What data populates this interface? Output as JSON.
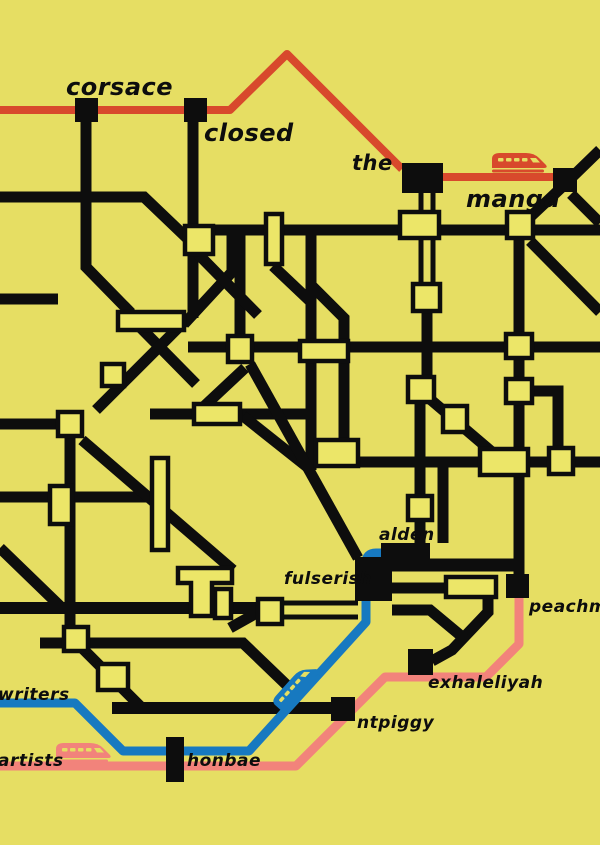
{
  "poster": {
    "title": "stylized transit map poster",
    "background": "#e6de63"
  },
  "colors": {
    "bg": "#e6de63",
    "ink": "#0d0d0d",
    "station": "#ece668",
    "red": "#d8492c",
    "blue": "#1779c0",
    "pink": "#f2837b"
  },
  "labels": {
    "corsace": "corsace",
    "closed": "closed",
    "the": "the",
    "manga": "manga",
    "alden": "alden",
    "fulserish": "fulserish",
    "peachmio": "peachmio",
    "exhaleliyah": "exhaleliyah",
    "ntpiggy": "ntpiggy",
    "honbae": "honbae",
    "writers": "writers",
    "artists": "artists"
  },
  "routes": [
    {
      "id": "red-line",
      "color": "#d8492c",
      "stations": [
        "corsace",
        "closed",
        "the",
        "manga"
      ]
    },
    {
      "id": "blue-line",
      "color": "#1779c0",
      "stations": [
        "writers",
        "honbae",
        "fulserish",
        "alden"
      ]
    },
    {
      "id": "pink-line",
      "color": "#f2837b",
      "stations": [
        "artists",
        "honbae",
        "ntpiggy",
        "exhaleliyah",
        "peachmio"
      ]
    }
  ],
  "trains": [
    {
      "icon": "red-train-icon",
      "route": "red-line"
    },
    {
      "icon": "blue-train-icon",
      "route": "blue-line"
    },
    {
      "icon": "pink-train-icon",
      "route": "pink-line"
    }
  ]
}
